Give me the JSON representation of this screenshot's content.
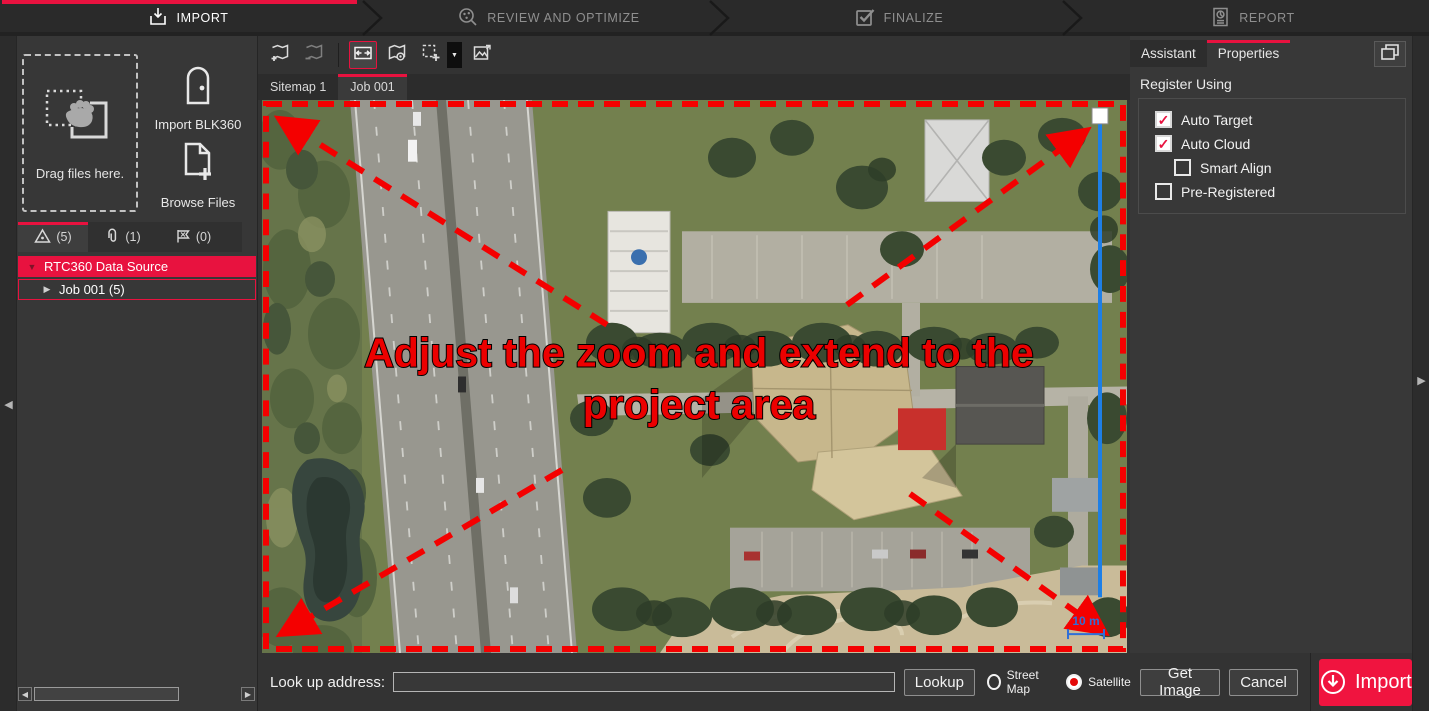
{
  "workflow": {
    "steps": [
      {
        "label": "IMPORT",
        "icon": "import-tray-icon",
        "active": true
      },
      {
        "label": "REVIEW AND OPTIMIZE",
        "icon": "magnifier-bundle-icon",
        "active": false
      },
      {
        "label": "FINALIZE",
        "icon": "checkbox-icon",
        "active": false
      },
      {
        "label": "REPORT",
        "icon": "report-document-icon",
        "active": false
      }
    ]
  },
  "left_panel": {
    "dropzone_label": "Drag files here.",
    "import_blk360_label": "Import BLK360",
    "browse_files_label": "Browse Files",
    "tabs": [
      {
        "icon": "setups-icon",
        "count": "(5)",
        "active": true
      },
      {
        "icon": "assets-paperclip-icon",
        "count": "(1)",
        "active": false
      },
      {
        "icon": "links-flag-icon",
        "count": "(0)",
        "active": false
      }
    ],
    "tree": [
      {
        "label": "RTC360 Data Source",
        "selected": true,
        "expanded": true
      },
      {
        "label": "Job 001 (5)",
        "selected": false,
        "expanded": false
      }
    ]
  },
  "toolbar": {
    "icons": [
      "add-sitemap-icon",
      "remove-sitemap-icon",
      "fit-to-extents-icon",
      "geo-locate-icon",
      "draw-region-icon",
      "insert-image-icon"
    ],
    "selected_tool": "fit-to-extents"
  },
  "map": {
    "tabs": [
      {
        "label": "Sitemap 1",
        "active": false
      },
      {
        "label": "Job 001",
        "active": true
      }
    ],
    "overlay_line1": "Adjust the zoom and extend to the",
    "overlay_line2": "project area",
    "scale_label": "10 m",
    "overlay_color": "#ec0000",
    "measure_color": "#1e7fe6"
  },
  "right_panel": {
    "tabs": [
      {
        "label": "Assistant",
        "active": false
      },
      {
        "label": "Properties",
        "active": true
      }
    ],
    "section_title": "Register Using",
    "options": [
      {
        "label": "Auto Target",
        "checked": true
      },
      {
        "label": "Auto Cloud",
        "checked": true
      },
      {
        "label": "Smart Align",
        "checked": false
      },
      {
        "label": "Pre-Registered",
        "checked": false
      }
    ]
  },
  "bottom_bar": {
    "address_label": "Look up address:",
    "address_value": "",
    "lookup_label": "Lookup",
    "street_map_label": "Street Map",
    "satellite_label": "Satellite",
    "street_map_selected": false,
    "satellite_selected": true,
    "get_image_label": "Get Image",
    "cancel_label": "Cancel",
    "import_label": "Import"
  },
  "colors": {
    "accent": "#e8123f",
    "overlay_red": "#ec0000",
    "measure_blue": "#1e7fe6"
  }
}
